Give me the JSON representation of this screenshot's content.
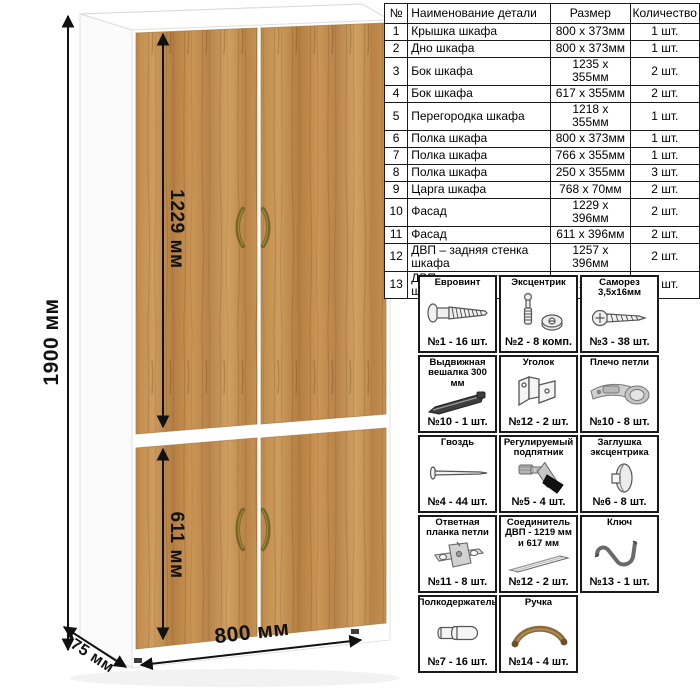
{
  "dimensions": {
    "height": "1900 мм",
    "upper_door_height": "1229 мм",
    "lower_door_height": "611 мм",
    "width": "800 мм",
    "depth": "375 мм"
  },
  "parts_table": {
    "headers": {
      "num": "№",
      "name": "Наименование детали",
      "size": "Размер",
      "qty": "Количество"
    },
    "rows": [
      {
        "num": "1",
        "name": "Крышка шкафа",
        "size": "800 х 373мм",
        "qty": "1 шт."
      },
      {
        "num": "2",
        "name": "Дно шкафа",
        "size": "800 х 373мм",
        "qty": "1 шт."
      },
      {
        "num": "3",
        "name": "Бок шкафа",
        "size": "1235 х 355мм",
        "qty": "2 шт."
      },
      {
        "num": "4",
        "name": "Бок шкафа",
        "size": "617 х 355мм",
        "qty": "2 шт."
      },
      {
        "num": "5",
        "name": "Перегородка шкафа",
        "size": "1218 х 355мм",
        "qty": "1 шт."
      },
      {
        "num": "6",
        "name": "Полка шкафа",
        "size": "800 х 373мм",
        "qty": "1 шт."
      },
      {
        "num": "7",
        "name": "Полка шкафа",
        "size": "766 х 355мм",
        "qty": "1 шт."
      },
      {
        "num": "8",
        "name": "Полка шкафа",
        "size": "250 х 355мм",
        "qty": "3 шт."
      },
      {
        "num": "9",
        "name": "Царга шкафа",
        "size": "768 х 70мм",
        "qty": "2 шт."
      },
      {
        "num": "10",
        "name": "Фасад",
        "size": "1229 х 396мм",
        "qty": "2 шт."
      },
      {
        "num": "11",
        "name": "Фасад",
        "size": "611 х 396мм",
        "qty": "2 шт."
      },
      {
        "num": "12",
        "name": "ДВП – задняя стенка шкафа",
        "size": "1257 х 396мм",
        "qty": "2 шт."
      },
      {
        "num": "13",
        "name": "ДВП – задняя стенка шкафа",
        "size": "639 х 396мм",
        "qty": "2 шт."
      }
    ]
  },
  "hardware": {
    "items": [
      {
        "title": "Евровинт",
        "count": "№1 - 16 шт."
      },
      {
        "title": "Эксцентрик",
        "count": "№2 - 8 комп."
      },
      {
        "title": "Саморез 3,5х16мм",
        "count": "№3 - 38 шт."
      },
      {
        "title": "Выдвижная вешалка 300 мм",
        "count": "№10 - 1 шт."
      },
      {
        "title": "Уголок",
        "count": "№12 - 2 шт."
      },
      {
        "title": "Плечо петли",
        "count": "№10 - 8 шт."
      },
      {
        "title": "Гвоздь",
        "count": "№4 - 44 шт."
      },
      {
        "title": "Регулируемый подпятник",
        "count": "№5 - 4 шт."
      },
      {
        "title": "Заглушка эксцентрика",
        "count": "№6 - 8 шт."
      },
      {
        "title": "Ответная планка петли",
        "count": "№11 - 8 шт."
      },
      {
        "title": "Соединитель ДВП - 1219 мм и 617 мм",
        "count": "№12 - 2 шт."
      },
      {
        "title": "Ключ",
        "count": "№13 - 1 шт."
      },
      {
        "title": "Полкодержатель",
        "count": "№7 - 16 шт."
      },
      {
        "title": "Ручка",
        "count": "№14 - 4 шт."
      }
    ]
  },
  "colors": {
    "wood_base": "#c08a4c",
    "wood_dark": "#b07c42",
    "wood_light": "#cfa061",
    "handle_bronze": "#77652a",
    "carcass_white": "#ffffff",
    "line_black": "#111111"
  }
}
